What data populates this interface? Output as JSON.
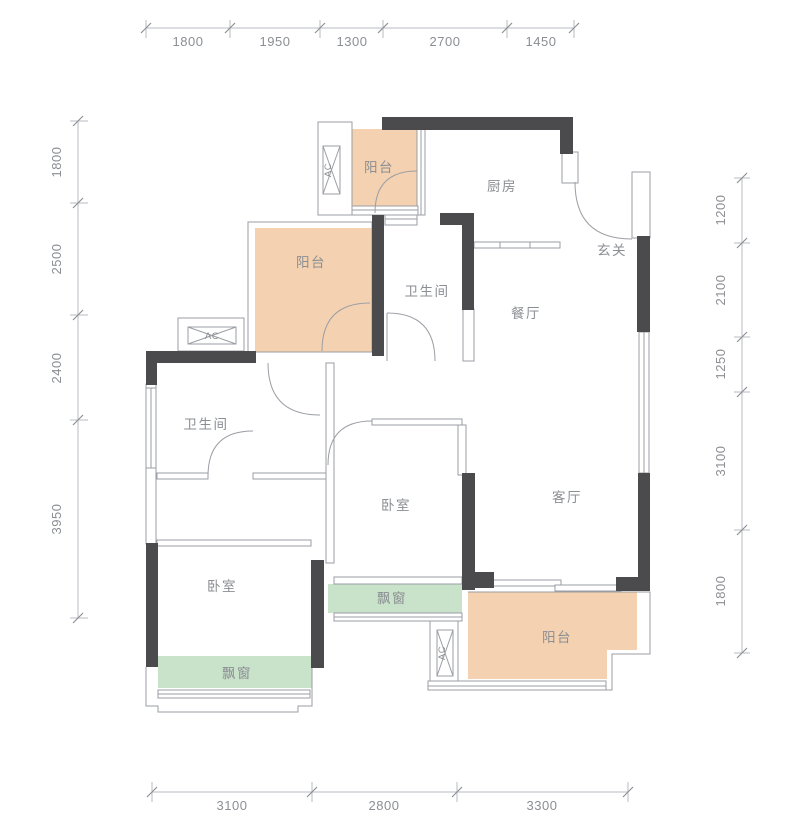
{
  "labels": {
    "balcony": "阳台",
    "kitchen": "厨房",
    "entry": "玄关",
    "bathroom": "卫生间",
    "dining": "餐厅",
    "living": "客厅",
    "bedroom": "卧室",
    "bay_window": "飘窗",
    "ac_unit": "AC"
  },
  "dimensions": {
    "top": [
      "1800",
      "1950",
      "1300",
      "2700",
      "1450"
    ],
    "left": [
      "1800",
      "2500",
      "2400",
      "3950"
    ],
    "right": [
      "1200",
      "2100",
      "1250",
      "3100",
      "1800"
    ],
    "bottom": [
      "3100",
      "2800",
      "3300"
    ]
  },
  "colors": {
    "balcony_fill": "#f4d1b0",
    "bay_window_fill": "#c9e2ca",
    "wall": "#4b4b4e",
    "line": "#9b9ea4",
    "text": "#8b8e93"
  }
}
